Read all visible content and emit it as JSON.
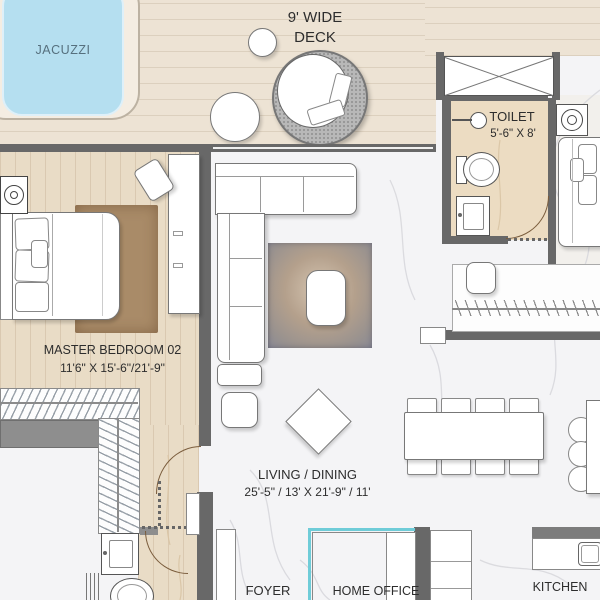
{
  "rooms": {
    "jacuzzi": {
      "label": "JACUZZI"
    },
    "deck": {
      "line1": "9' WIDE",
      "line2": "DECK"
    },
    "toilet": {
      "label": "TOILET",
      "dims": "5'-6\" X 8'"
    },
    "master_bedroom": {
      "label": "MASTER BEDROOM 02",
      "dims": "11'6\" X 15'-6\"/21'-9\""
    },
    "living_dining": {
      "label": "LIVING / DINING",
      "dims": "25'-5\" / 13' X 21'-9\" / 11'"
    },
    "foyer": {
      "label": "FOYER"
    },
    "home_office": {
      "label": "HOME OFFICE"
    },
    "kitchen": {
      "label": "KITCHEN"
    }
  },
  "colors": {
    "wall": "#686868",
    "deck-floor": "#ede3d4",
    "wood-floor": "#e9dcc6",
    "tile-floor": "#ecdcc2",
    "marble-floor": "#f4f4f6",
    "jacuzzi-water": "#b5dff0",
    "glass-partition": "#6fccd8",
    "bedroom-rug": "#a98b68",
    "label-text": "#2d2d2d",
    "jacuzzi-text": "#56707e",
    "door-arc": "#7a5c3c"
  }
}
